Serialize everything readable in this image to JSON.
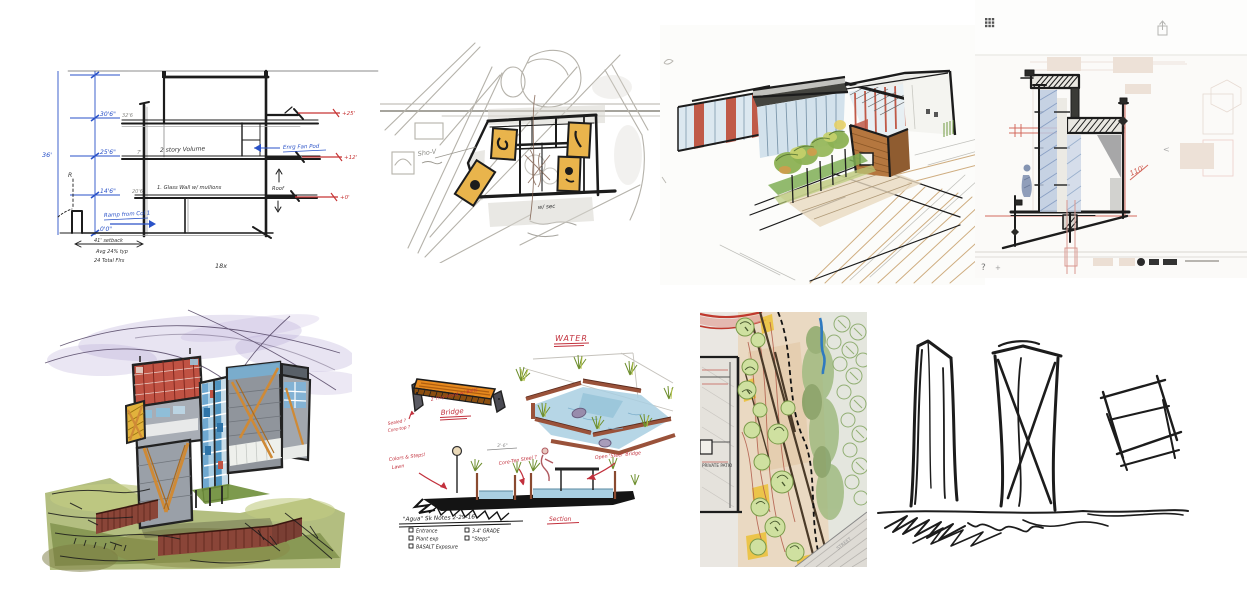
{
  "palette": {
    "ink_black": "#1c1c1c",
    "pencil_gray": "#8a8a86",
    "dim_blue": "#2a52c8",
    "marker_red": "#c63434",
    "highlight_yellow": "#e9b44c",
    "glass_blue": "#7fb4d8",
    "wood_brown": "#b5773f",
    "accent_red": "#c05a48",
    "foliage_green": "#8cb153",
    "water_blue": "#a9cfe2",
    "corten_rust": "#9a523a",
    "wash_purple": "#b4a4d4",
    "watercolor_green": "#8aa24e",
    "note_red": "#c2303c"
  },
  "sketches": {
    "s1": {
      "total_height": "36'",
      "levels": [
        "30'6\"",
        "25'6\"",
        "14'6\"",
        "0'0\""
      ],
      "wall_marks": [
        "32'6",
        "7'",
        "20'6"
      ],
      "note_volume": "2 story Volume",
      "note_glass": "1. Glass Wall w/ mullions",
      "note_pod": "Enrg Fan Pod",
      "note_roof": "Roof",
      "note_r": "R",
      "note_ramp": "Ramp from Col 1",
      "red_marks": [
        "+25'",
        "+12'",
        "+0'"
      ],
      "footer_dim": "41' setback",
      "footer_note1": "Avg 24% typ",
      "footer_note2": "24 Total Flrs",
      "scale_note": "18x"
    },
    "s2": {
      "label_shov": "Sho-V",
      "label_sec": "w/ sec"
    },
    "s4": {
      "red_note": "110'",
      "help_label": "?",
      "plus_label": "+",
      "nav_back": "<"
    },
    "s6": {
      "title_water": "WATER",
      "label_bridge": "Bridge",
      "label_section": "Section",
      "note_bridge": "2' Hvy wood w/ Bolts",
      "note_steel1": "Sealed ?",
      "note_steel2": "Core-top ?",
      "note_lawn1": "Colors & Steps!",
      "note_lawn2": "Lawn",
      "note_coreten": "Core-Ten Steel ?",
      "note_openbridge": "Open 'Steel' Bridge",
      "note_dim": "3'-6\"",
      "title_notes": "\"Agua\" Sk Notes  2-29-16",
      "checklist_col1": [
        "Entrance",
        "Plant exp",
        "BASALT Exposure"
      ],
      "checklist_col2": [
        "3-4' GRADE",
        "\"Steps\""
      ]
    },
    "s7": {
      "label_patio": "PRIVATE PATIO",
      "label_street": "STREET"
    }
  }
}
